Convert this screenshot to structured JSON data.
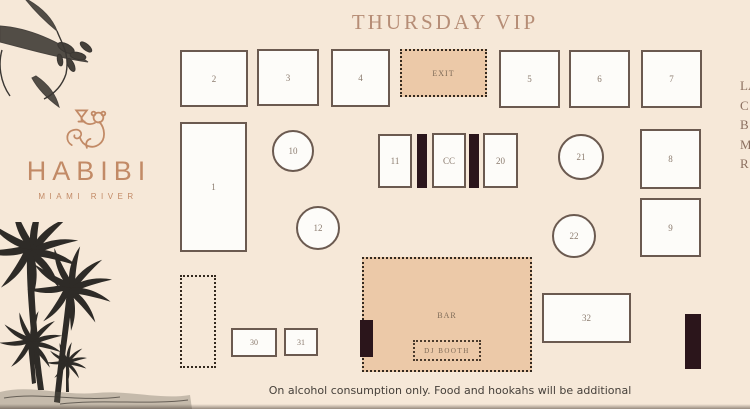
{
  "header": {
    "title": "THURSDAY VIP"
  },
  "brand": {
    "name": "HABIBI",
    "subtitle": "MIAMI RIVER"
  },
  "plan": {
    "exit_label": "EXIT",
    "cc_label": "CC",
    "bar_label": "BAR",
    "dj_booth_label": "DJ BOOTH",
    "tables": {
      "1": "1",
      "2": "2",
      "3": "3",
      "4": "4",
      "5": "5",
      "6": "6",
      "7": "7",
      "8": "8",
      "9": "9",
      "10": "10",
      "11": "11",
      "12": "12",
      "20": "20",
      "21": "21",
      "22": "22",
      "30": "30",
      "31": "31",
      "32": "32"
    }
  },
  "right_edge_text": {
    "lines": [
      "LA",
      "C",
      "B",
      "M",
      "R"
    ]
  },
  "footer": {
    "disclaimer": "On alcohol consumption only. Food and hookahs will be additional"
  },
  "colors": {
    "background": "#f6e8d8",
    "zone_fill": "#ecc9a8",
    "table_fill": "#fdfcf9",
    "table_border": "#6b5a50",
    "dark_block": "#2b151b",
    "title_text": "#b68d76",
    "number_text": "#8b7b6e",
    "brand_copper": "#c28a66",
    "disclaimer_text": "#46403a"
  }
}
